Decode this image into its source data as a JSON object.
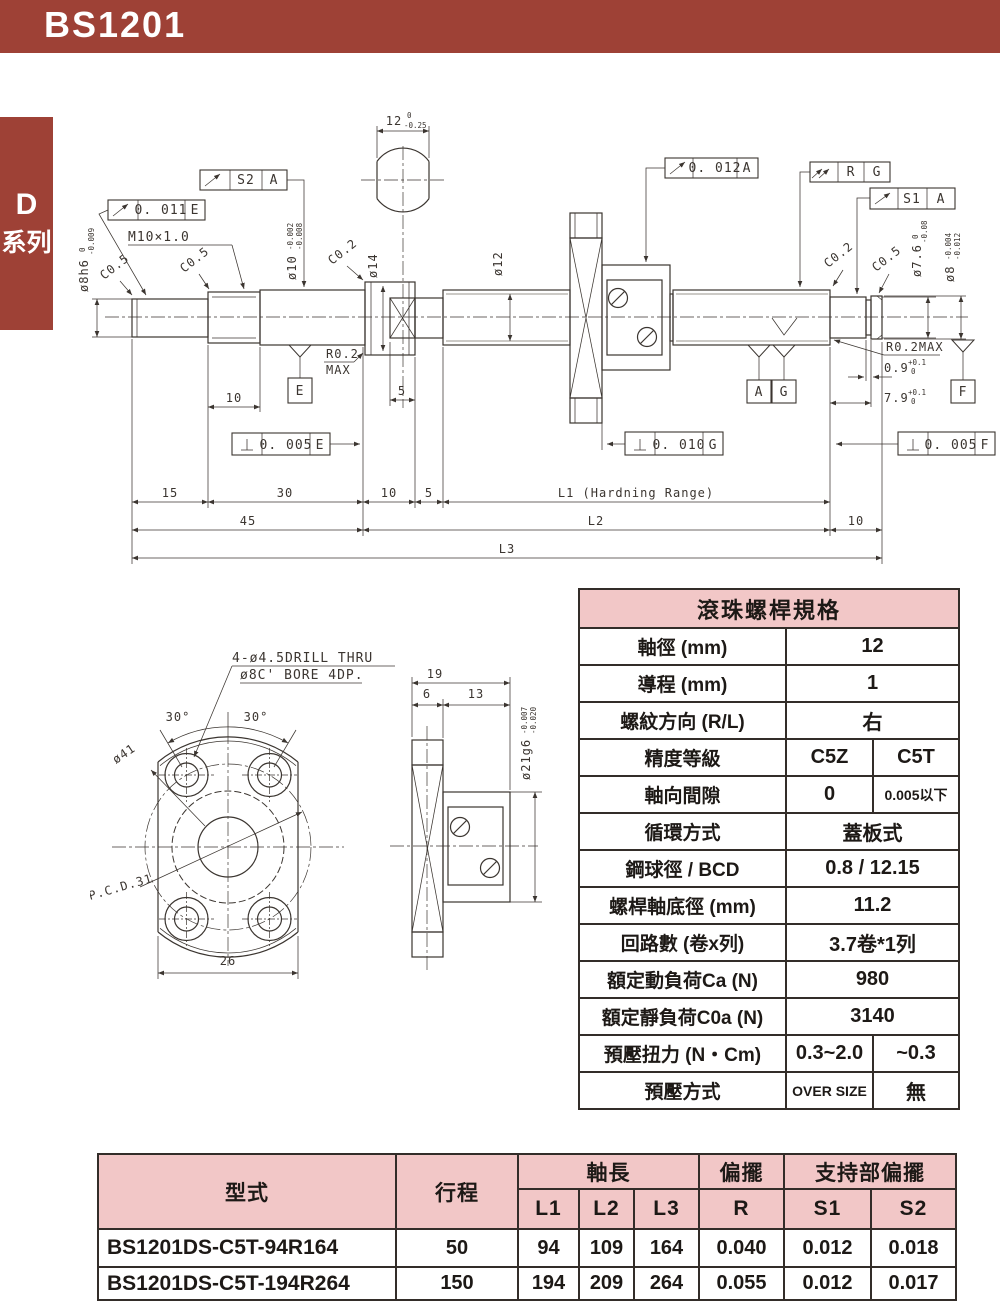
{
  "page": {
    "product_code": "BS1201",
    "series_tab_line1": "D",
    "series_tab_line2": "系列",
    "accent_color": "#9e4136",
    "table_header_pink": "#f2c7c7"
  },
  "drawing": {
    "dims": {
      "d12": "12",
      "d12_tu": "0",
      "d12_tl": "-0.25",
      "dia8h6": "ø8h6",
      "dia8h6_tu": "0",
      "dia8h6_tl": "-0.009",
      "dia10": "ø10",
      "dia10_tu": "-0.002",
      "dia10_tl": "-0.008",
      "dia14": "ø14",
      "dia12": "ø12",
      "dia76": "ø7.6",
      "dia76_tu": "0",
      "dia76_tl": "-0.08",
      "dia8r": "ø8",
      "dia8r_tu": "-0.004",
      "dia8r_tl": "-0.012",
      "m10": "M10×1.0",
      "c05": "C0.5",
      "c02": "C0.2",
      "r02max_l1": "R0.2",
      "r02max_l2": "MAX",
      "r02max_r": "R0.2MAX",
      "d09": "0.9",
      "d09_tu": "+0.1",
      "d09_tl": "0",
      "d79": "7.9",
      "d79_tu": "+0.1",
      "d79_tl": "0",
      "len10m": "10",
      "len5c": "5",
      "len15": "15",
      "len30": "30",
      "len10a": "10",
      "len5": "5",
      "lenL1": "L1 (Hardning Range)",
      "len45": "45",
      "lenL2": "L2",
      "len10b": "10",
      "lenL3": "L3"
    },
    "frames": {
      "s2": {
        "v": "S2",
        "d": "A"
      },
      "e011": {
        "v": "0. 011",
        "d": "E"
      },
      "a012": {
        "v": "0. 012",
        "d": "A"
      },
      "rg": {
        "v": "R",
        "d": "G"
      },
      "s1": {
        "v": "S1",
        "d": "A"
      },
      "perp_e": {
        "v": "0. 005",
        "d": "E"
      },
      "perp_g": {
        "v": "0. 010",
        "d": "G"
      },
      "perp_f": {
        "v": "0. 005",
        "d": "F"
      }
    },
    "datums": {
      "e": "E",
      "a": "A",
      "g": "G",
      "f": "F"
    },
    "flange_view": {
      "note1": "4-ø4.5DRILL THRU",
      "note2": "ø8C' BORE 4DP.",
      "angle1": "30°",
      "angle2": "30°",
      "dia41": "ø41",
      "pcd": "P.C.D.31",
      "w26": "26",
      "d19": "19",
      "d6": "6",
      "d13": "13",
      "dia21": "ø21g6",
      "dia21_tu": "-0.007",
      "dia21_tl": "-0.020"
    }
  },
  "spec_table": {
    "title": "滾珠螺桿規格",
    "rows": [
      {
        "label": "軸徑 (mm)",
        "value": "12"
      },
      {
        "label": "導程 (mm)",
        "value": "1"
      },
      {
        "label": "螺紋方向 (R/L)",
        "value": "右"
      },
      {
        "label": "精度等級",
        "v1": "C5Z",
        "v2": "C5T"
      },
      {
        "label": "軸向間隙",
        "v1": "0",
        "v2": "0.005以下"
      },
      {
        "label": "循環方式",
        "value": "蓋板式"
      },
      {
        "label": "鋼球徑 / BCD",
        "value": "0.8 / 12.15"
      },
      {
        "label": "螺桿軸底徑 (mm)",
        "value": "11.2"
      },
      {
        "label": "回路數 (卷x列)",
        "value": "3.7卷*1列"
      },
      {
        "label": "額定動負荷Ca  (N)",
        "value": "980"
      },
      {
        "label": "額定靜負荷C0a  (N)",
        "value": "3140"
      },
      {
        "label": "預壓扭力  (N・Cm)",
        "v1": "0.3~2.0",
        "v2": "~0.3"
      },
      {
        "label": "預壓方式",
        "v1": "OVER SIZE",
        "v2": "無"
      }
    ]
  },
  "model_table": {
    "headers": {
      "model": "型式",
      "stroke": "行程",
      "shaft_len": "軸長",
      "runout": "偏擺",
      "support_runout": "支持部偏擺",
      "l1": "L1",
      "l2": "L2",
      "l3": "L3",
      "r": "R",
      "s1": "S1",
      "s2": "S2"
    },
    "rows": [
      {
        "model": "BS1201DS-C5T-94R164",
        "stroke": "50",
        "l1": "94",
        "l2": "109",
        "l3": "164",
        "r": "0.040",
        "s1": "0.012",
        "s2": "0.018"
      },
      {
        "model": "BS1201DS-C5T-194R264",
        "stroke": "150",
        "l1": "194",
        "l2": "209",
        "l3": "264",
        "r": "0.055",
        "s1": "0.012",
        "s2": "0.017"
      }
    ]
  }
}
